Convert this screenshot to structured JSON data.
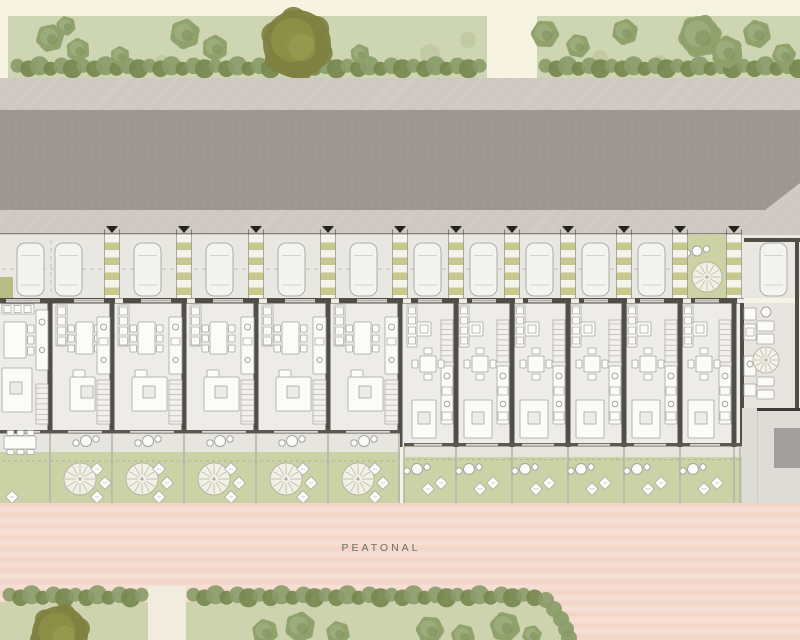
{
  "street": {
    "label": "PEATONAL"
  },
  "meta": {
    "drawing_type": "residential site plan",
    "wide_townhouses": 6,
    "narrow_townhouses": 6,
    "corner_units": 1,
    "parked_cars": 12,
    "entry_markers": 11
  },
  "colors": {
    "cream": "#f7f3e2",
    "lawn_top": "#ced5b2",
    "lawn_bottom": "#cdd3ae",
    "lawn_spot": "#c2caa3",
    "hedge": "#8b9c6a",
    "hedge_dark": "#75884e",
    "tree_green": "#8fa06b",
    "tree_green_light": "#a3b183",
    "tree_green_dark": "#71854b",
    "olive": "#7e8140",
    "olive_mid": "#919447",
    "olive_light": "#a6a858",
    "sidewalk": "#cfc9c2",
    "road": "#9d9691",
    "paving": "#e8e7e2",
    "stripe_olive": "#c6c88e",
    "stripe_cream": "#f4f4ec",
    "court_green": "#ccd2a4",
    "wall": "#514e48",
    "wall2": "#5b5852",
    "floor": "#edece8",
    "patio": "#e8e5e0",
    "white": "#fbfbf8",
    "furn_line": "#a7a5a0",
    "lawn_garden": "#cbd2a5",
    "terrace": "#e7e5e0",
    "pink": "#f4d9cc",
    "plaza": "#dedcd7",
    "plaza_dark": "#a19f9b",
    "car": "#f3f3f0",
    "car_line": "#aeaca7",
    "fence": "#b3b1ac",
    "dash": "#bfbdb7",
    "ink": "#6b6862",
    "glass": "#d7d5d0",
    "marker": "#24231f"
  },
  "bands": {
    "green_top": [
      16,
      78
    ],
    "sidewalk_top": [
      78,
      110
    ],
    "road": [
      110,
      210
    ],
    "sidewalk_bottom": [
      210,
      235
    ],
    "parking": [
      235,
      298
    ],
    "facade_y": 298,
    "left_rear_y": 430,
    "right_rear_y": 443,
    "street_top": 503,
    "bottom_green_top": 588
  },
  "site": {
    "walkways": [
      112,
      184,
      256,
      328,
      400,
      456,
      512,
      568,
      624,
      680,
      734
    ],
    "left_units": [
      [
        0,
        50
      ],
      [
        50,
        112
      ],
      [
        112,
        184
      ],
      [
        184,
        256
      ],
      [
        256,
        328
      ],
      [
        328,
        400
      ]
    ],
    "right_units": [
      [
        404,
        456
      ],
      [
        456,
        512
      ],
      [
        512,
        568
      ],
      [
        568,
        624
      ],
      [
        624,
        680
      ],
      [
        680,
        734
      ]
    ],
    "cars": [
      [
        17,
        243
      ],
      [
        55,
        243
      ],
      [
        134,
        243
      ],
      [
        206,
        243
      ],
      [
        278,
        243
      ],
      [
        350,
        243
      ],
      [
        414,
        243
      ],
      [
        470,
        243
      ],
      [
        526,
        243
      ],
      [
        582,
        243
      ],
      [
        638,
        243
      ],
      [
        760,
        243
      ]
    ],
    "car_size": [
      27,
      53
    ],
    "courtyard_bay": [
      687.5,
      726.5
    ],
    "corner_unit": [
      734,
      800
    ],
    "green_gap_top": [
      487,
      537
    ],
    "path_gap_bottom": [
      148,
      186
    ],
    "hedge_top_spans": [
      [
        12,
        484
      ],
      [
        540,
        796
      ]
    ],
    "hedge_bottom_spans": [
      [
        4,
        146
      ],
      [
        188,
        536
      ]
    ],
    "hedge_curve": [
      [
        546,
        600
      ],
      [
        554,
        609
      ],
      [
        561,
        619
      ],
      [
        566,
        629
      ],
      [
        569,
        638
      ]
    ],
    "trees_top": [
      [
        50,
        38,
        13,
        "g"
      ],
      [
        78,
        50,
        11,
        "g"
      ],
      [
        66,
        26,
        9,
        "g"
      ],
      [
        120,
        56,
        9,
        "g"
      ],
      [
        185,
        34,
        14,
        "g"
      ],
      [
        215,
        48,
        12,
        "g"
      ],
      [
        297,
        44,
        34,
        "o"
      ],
      [
        360,
        54,
        9,
        "g"
      ],
      [
        545,
        34,
        13,
        "g"
      ],
      [
        578,
        46,
        11,
        "g"
      ],
      [
        625,
        32,
        12,
        "g"
      ],
      [
        700,
        36,
        20,
        "g"
      ],
      [
        727,
        52,
        15,
        "g"
      ],
      [
        757,
        34,
        13,
        "g"
      ],
      [
        784,
        55,
        11,
        "g"
      ]
    ],
    "lawn_spots_top": [
      [
        430,
        54,
        10
      ],
      [
        468,
        40,
        8
      ],
      [
        600,
        58,
        8
      ],
      [
        162,
        62,
        7
      ],
      [
        660,
        62,
        7
      ]
    ],
    "trees_bottom": [
      [
        60,
        634,
        28,
        "o"
      ],
      [
        265,
        632,
        12,
        "g"
      ],
      [
        300,
        627,
        14,
        "g"
      ],
      [
        338,
        633,
        11,
        "g"
      ],
      [
        430,
        630,
        13,
        "g"
      ],
      [
        463,
        636,
        11,
        "g"
      ],
      [
        505,
        627,
        14,
        "g"
      ],
      [
        532,
        635,
        9,
        "g"
      ]
    ],
    "plaza": {
      "rect": [
        742,
        408,
        58,
        95
      ],
      "dark_rect": [
        774,
        428,
        26,
        40
      ],
      "wall_y": 408
    }
  }
}
